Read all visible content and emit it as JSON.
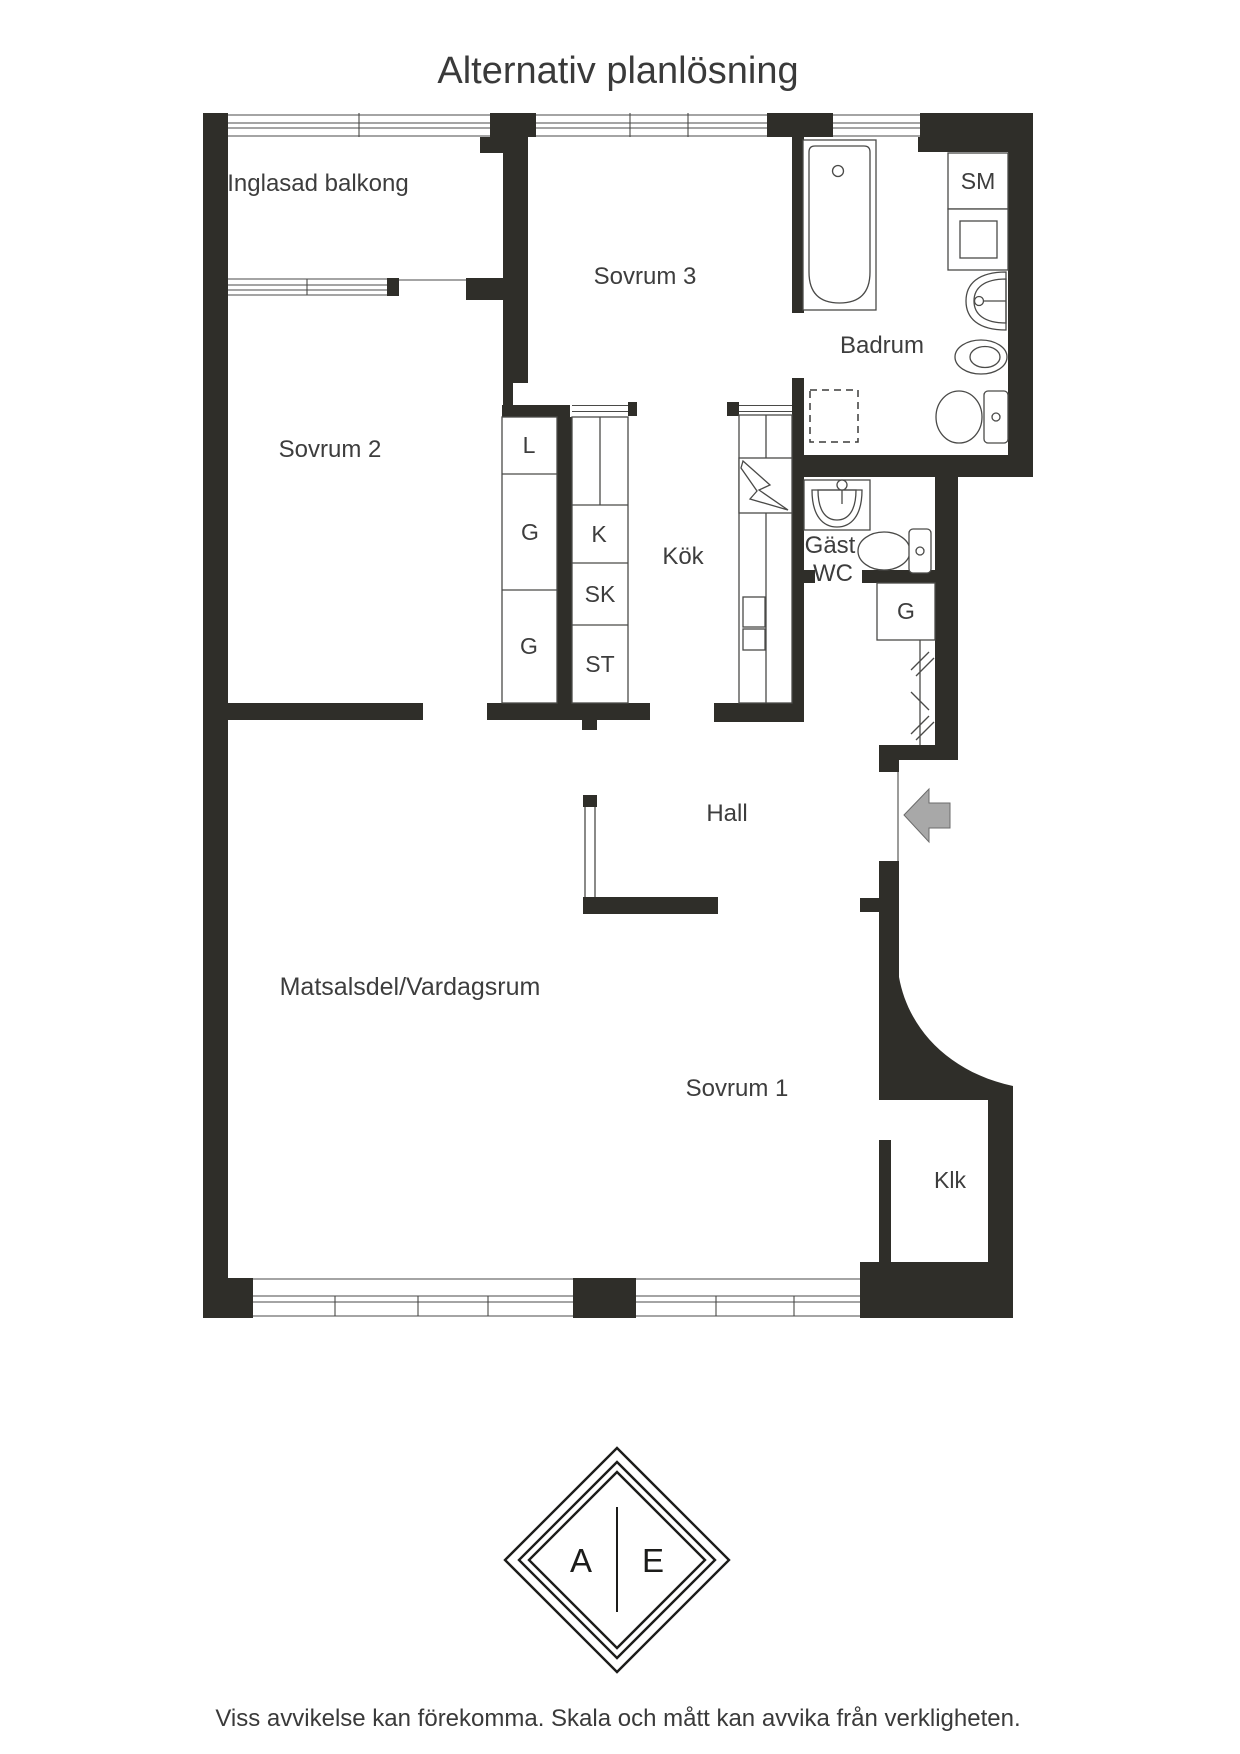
{
  "page": {
    "title": "Alternativ planlösning",
    "disclaimer": "Viss avvikelse kan förekomma. Skala och mått kan avvika från verkligheten."
  },
  "floorplan": {
    "rooms": {
      "balcony": "Inglasad balkong",
      "bedroom3": "Sovrum 3",
      "bathroom": "Badrum",
      "bedroom2": "Sovrum 2",
      "kitchen": "Kök",
      "guest_wc_line1": "Gäst",
      "guest_wc_line2": "WC",
      "hall": "Hall",
      "living_room": "Matsalsdel/Vardagsrum",
      "bedroom1": "Sovrum 1",
      "walk_in_closet": "Klk"
    },
    "cabinets": {
      "sm": "SM",
      "linen": "L",
      "g_upper": "G",
      "g_lower": "G",
      "fridge": "K",
      "sk": "SK",
      "st": "ST",
      "g_hall": "G"
    },
    "icons": [
      "bathtub-icon",
      "shower-icon",
      "bathroom-sink-icon",
      "bidet-icon",
      "toilet-icon",
      "washing-machine-icon",
      "guest-sink-icon",
      "guest-toilet-icon",
      "stove-icon",
      "entry-arrow-icon",
      "sliding-door-icon",
      "window-icon"
    ],
    "colors": {
      "wall": "#2f2e29",
      "line": "#4a4a48",
      "text": "#3d3d3d",
      "arrow": "#a8a8a8"
    }
  },
  "logo": {
    "left_letter": "A",
    "right_letter": "E"
  }
}
